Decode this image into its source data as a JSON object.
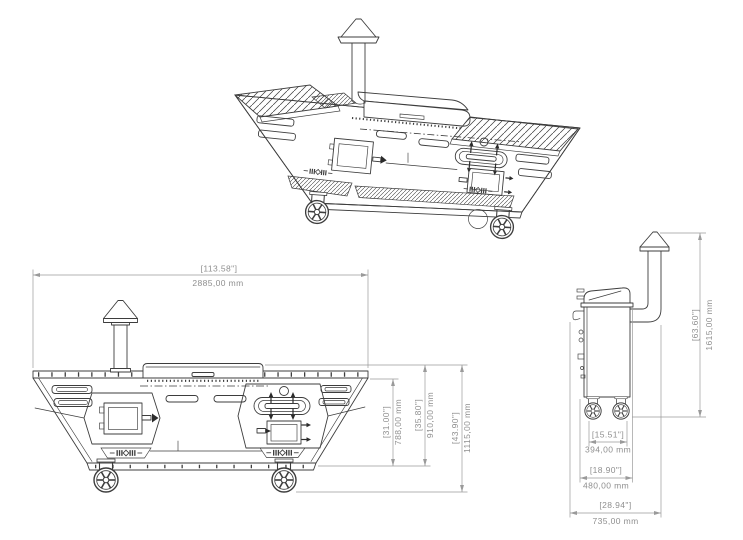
{
  "drawing": {
    "line_color": "#3d3d3d",
    "dimension_color": "#9a9a9a",
    "front_dims": {
      "width_in": "[113.58\"]",
      "width_mm": "2885,00 mm",
      "table_height_in": "[31.00\"]",
      "table_height_mm": "788,00 mm",
      "lid_height_in": "[35.80\"]",
      "lid_height_mm": "910,00 mm",
      "total_height_in": "[43.90\"]",
      "total_height_mm": "1115,00 mm"
    },
    "side_dims": {
      "wheel_track_in": "[15.51\"]",
      "wheel_track_mm": "394,00 mm",
      "body_depth_in": "[18.90\"]",
      "body_depth_mm": "480,00 mm",
      "total_depth_in": "[28.94\"]",
      "total_depth_mm": "735,00 mm",
      "total_height_in": "[63.60\"]",
      "total_height_mm": "1615,00 mm"
    }
  }
}
